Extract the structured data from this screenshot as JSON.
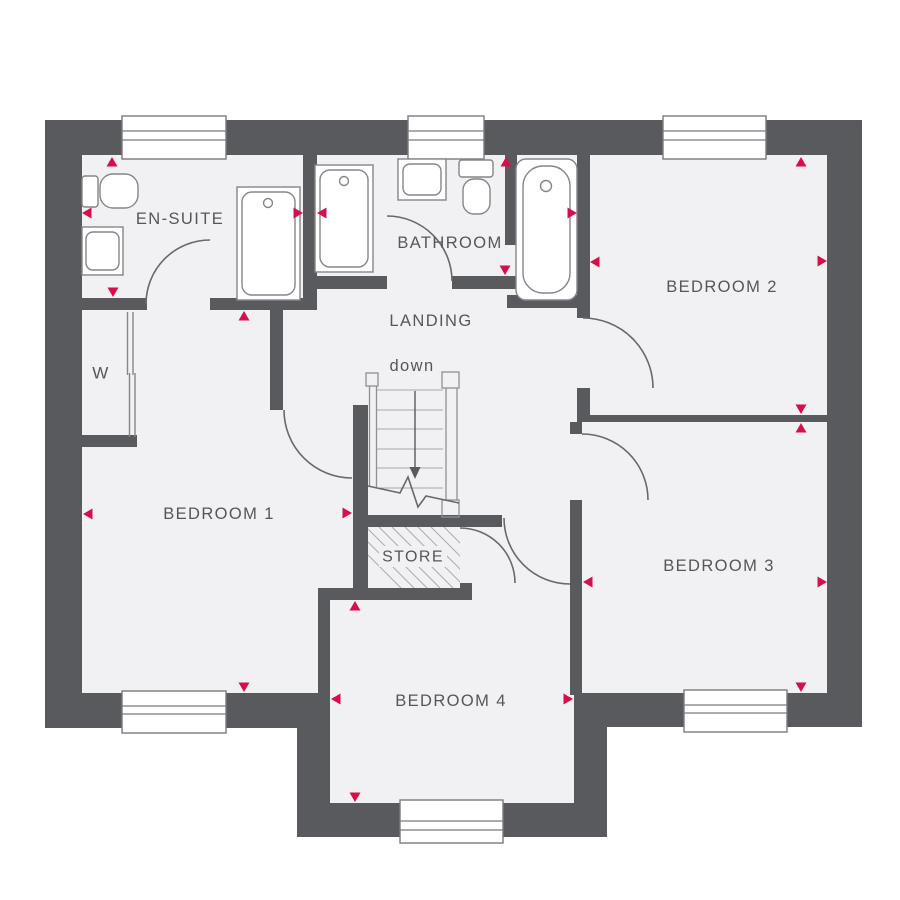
{
  "plan": {
    "floor_name": "floor-plan",
    "colors": {
      "wall": "#595a5d",
      "floor": "#f1f1f4",
      "outside": "#ffffff",
      "fixture_line": "#85858a",
      "door_line": "#68686d",
      "window_line": "#7b7b80",
      "stair_line": "#8f8f94",
      "tread_line": "#a7a7ab",
      "hatch_line": "#aeaeb2",
      "arrow_line": "#5a5a5e",
      "label": "#55565b",
      "marker": "#d60f4c"
    },
    "rooms": [
      {
        "id": "en-suite",
        "label": "EN-SUITE",
        "x": 180,
        "y": 219,
        "size": 16.5
      },
      {
        "id": "bathroom",
        "label": "BATHROOM",
        "x": 450,
        "y": 243,
        "size": 16.5
      },
      {
        "id": "landing",
        "label": "LANDING",
        "x": 431,
        "y": 321,
        "size": 16.5
      },
      {
        "id": "bedroom-1",
        "label": "BEDROOM 1",
        "x": 219,
        "y": 514,
        "size": 16.5
      },
      {
        "id": "bedroom-2",
        "label": "BEDROOM 2",
        "x": 722,
        "y": 287,
        "size": 16.5
      },
      {
        "id": "bedroom-3",
        "label": "BEDROOM 3",
        "x": 719,
        "y": 566,
        "size": 16.5
      },
      {
        "id": "bedroom-4",
        "label": "BEDROOM 4",
        "x": 451,
        "y": 701,
        "size": 16.5
      },
      {
        "id": "store",
        "label": "STORE",
        "x": 413,
        "y": 557,
        "size": 16
      },
      {
        "id": "wardrobe",
        "label": "W",
        "x": 101,
        "y": 373,
        "size": 17
      }
    ],
    "stairs": {
      "label": "down",
      "x": 412,
      "y": 366,
      "size": 16.5
    },
    "markers": [
      {
        "x": 112,
        "y": 157,
        "dir": "up"
      },
      {
        "x": 82,
        "y": 213,
        "dir": "left"
      },
      {
        "x": 113,
        "y": 297,
        "dir": "down"
      },
      {
        "x": 244,
        "y": 311,
        "dir": "up"
      },
      {
        "x": 303,
        "y": 213,
        "dir": "right"
      },
      {
        "x": 317,
        "y": 213,
        "dir": "left"
      },
      {
        "x": 506,
        "y": 157,
        "dir": "up"
      },
      {
        "x": 505,
        "y": 275,
        "dir": "down"
      },
      {
        "x": 577,
        "y": 213,
        "dir": "right"
      },
      {
        "x": 590,
        "y": 262,
        "dir": "left"
      },
      {
        "x": 801,
        "y": 157,
        "dir": "up"
      },
      {
        "x": 827,
        "y": 261,
        "dir": "right"
      },
      {
        "x": 801,
        "y": 414,
        "dir": "down"
      },
      {
        "x": 801,
        "y": 423,
        "dir": "up"
      },
      {
        "x": 583,
        "y": 582,
        "dir": "left"
      },
      {
        "x": 827,
        "y": 582,
        "dir": "right"
      },
      {
        "x": 801,
        "y": 692,
        "dir": "down"
      },
      {
        "x": 355,
        "y": 601,
        "dir": "up"
      },
      {
        "x": 331,
        "y": 699,
        "dir": "left"
      },
      {
        "x": 573,
        "y": 699,
        "dir": "right"
      },
      {
        "x": 355,
        "y": 802,
        "dir": "down"
      },
      {
        "x": 83,
        "y": 514,
        "dir": "left"
      },
      {
        "x": 352,
        "y": 513,
        "dir": "right"
      },
      {
        "x": 244,
        "y": 692,
        "dir": "down"
      }
    ]
  }
}
